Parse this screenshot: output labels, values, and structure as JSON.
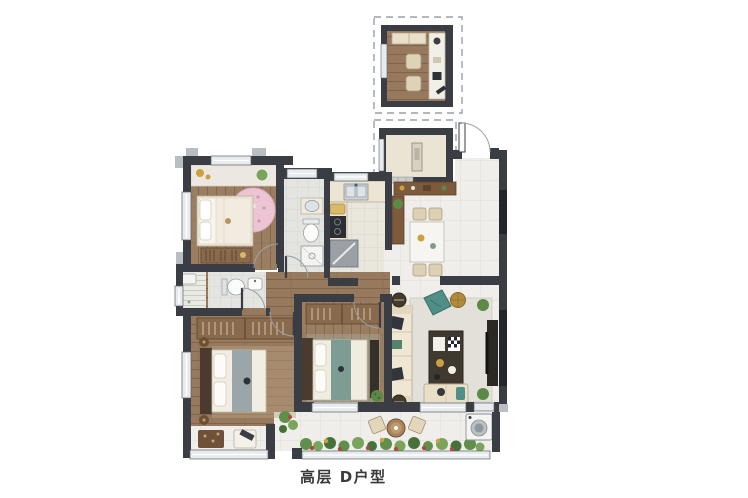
{
  "caption": {
    "text": "高层 D户型"
  },
  "plan": {
    "type": "residential-floor-plan",
    "modules": [
      "optional-room-top-dashed",
      "equipment-platform-dashed",
      "main-unit"
    ],
    "rooms": [
      {
        "name": "optional-room-top",
        "furniture": [
          "bench",
          "desk",
          "two-chairs",
          "window"
        ]
      },
      {
        "name": "equipment-platform",
        "furniture": [
          "equipment-box",
          "window"
        ]
      },
      {
        "name": "bedroom-top-left",
        "furniture": [
          "single-bed",
          "pink-round-rug",
          "book-dresser",
          "bay-window-sill",
          "plant"
        ]
      },
      {
        "name": "bathroom-inner",
        "furniture": [
          "washbasin",
          "toilet",
          "shower-tray",
          "window"
        ]
      },
      {
        "name": "shower-nook",
        "furniture": [
          "striped-floor",
          "window"
        ]
      },
      {
        "name": "bathroom-hall",
        "furniture": [
          "toilet",
          "washbasin"
        ]
      },
      {
        "name": "kitchen",
        "furniture": [
          "sink-counter",
          "cutting-board",
          "cooktop",
          "refrigerator"
        ]
      },
      {
        "name": "entry-foyer",
        "furniture": [
          "entry-door",
          "shoe-cabinet",
          "side-cabinet",
          "plant"
        ]
      },
      {
        "name": "dining-room",
        "furniture": [
          "dining-table",
          "four-chairs",
          "east-window"
        ]
      },
      {
        "name": "hallway",
        "furniture": []
      },
      {
        "name": "master-bedroom",
        "furniture": [
          "double-bed",
          "wardrobe",
          "nightstands",
          "bay-window-seat",
          "armchair",
          "rug"
        ]
      },
      {
        "name": "bedroom-center",
        "furniture": [
          "double-bed",
          "wardrobe",
          "foot-cabinet",
          "plant"
        ]
      },
      {
        "name": "living-room",
        "furniture": [
          "sofa",
          "side-tables",
          "accent-chair",
          "gold-pouf",
          "coffee-table",
          "daybed",
          "tv-console",
          "plants",
          "east-window"
        ]
      },
      {
        "name": "balcony",
        "furniture": [
          "planter-row",
          "bistro-table",
          "two-chairs",
          "washing-machine"
        ]
      }
    ],
    "colors": {
      "wall": "#3a3d44",
      "wood_floor": "#9a7e62",
      "marble_tile": "#efeeea",
      "bath_tile": "#e4e5e0",
      "window_glass_dark": "#23262b",
      "window_light": "#e7ebed",
      "cabinet_brown": "#7d5a3c",
      "accent_teal": "#4f8f88",
      "accent_pink": "#ecc4d4",
      "accent_gold": "#c9a23f",
      "plant_green": "#5f8f4a",
      "background": "#ffffff"
    }
  }
}
